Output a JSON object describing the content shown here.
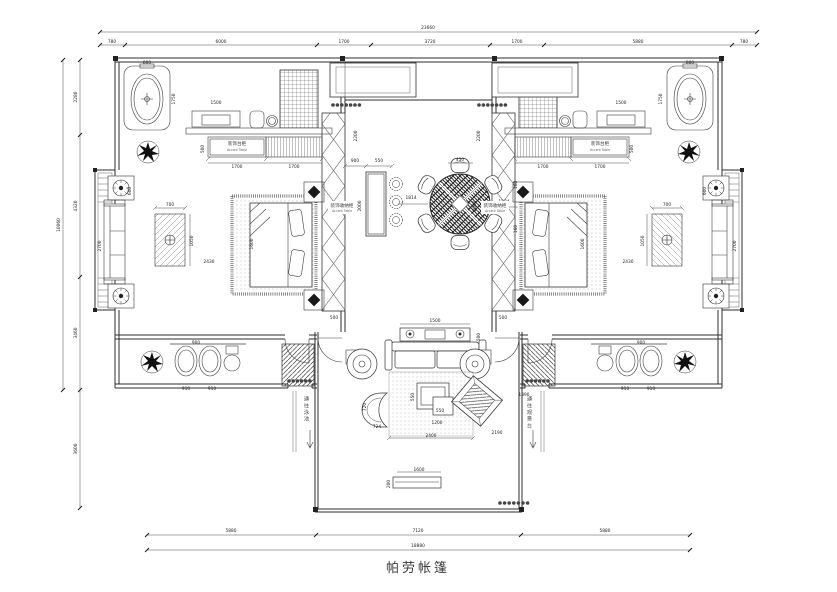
{
  "title": "帕劳帐篷",
  "colors": {
    "line": "#2e2e2e",
    "dark_fill": "#141414",
    "background": "#ffffff"
  },
  "labels": {
    "accent_left_zh": "装饰台柜",
    "accent_left_en": "Accent Table",
    "accent_right_zh": "装饰台柜",
    "accent_right_en": "Accent Table",
    "console_left_zh": "装饰收纳柜",
    "console_left_en": "Accent Table",
    "console_right_zh": "装饰收纳柜",
    "console_right_en": "Accent Table",
    "passage_left": "通往泳池",
    "passage_right": "通往观景台"
  },
  "dimensions": {
    "top": [
      {
        "t": "23660",
        "x": 428,
        "y": 29
      },
      {
        "t": "780",
        "x": 112,
        "y": 43
      },
      {
        "t": "6000",
        "x": 221,
        "y": 43
      },
      {
        "t": "1700",
        "x": 344,
        "y": 43
      },
      {
        "t": "3720",
        "x": 430,
        "y": 43
      },
      {
        "t": "1700",
        "x": 517,
        "y": 43
      },
      {
        "t": "5880",
        "x": 638,
        "y": 43
      },
      {
        "t": "780",
        "x": 744,
        "y": 43
      }
    ],
    "bottom": [
      {
        "t": "5880",
        "x": 231,
        "y": 532
      },
      {
        "t": "7120",
        "x": 418,
        "y": 532
      },
      {
        "t": "5880",
        "x": 605,
        "y": 532
      },
      {
        "t": "18880",
        "x": 418,
        "y": 547
      }
    ],
    "left": [
      {
        "t": "10060",
        "x": 60,
        "y": 225,
        "r": 1
      },
      {
        "t": "2280",
        "x": 77,
        "y": 97,
        "r": 1
      },
      {
        "t": "4320",
        "x": 77,
        "y": 206,
        "r": 1
      },
      {
        "t": "3460",
        "x": 77,
        "y": 333,
        "r": 1
      },
      {
        "t": "3600",
        "x": 77,
        "y": 449,
        "r": 1
      }
    ],
    "interior": [
      {
        "t": "800",
        "x": 147,
        "y": 64
      },
      {
        "t": "1750",
        "x": 175,
        "y": 99,
        "r": 1
      },
      {
        "t": "1500",
        "x": 216,
        "y": 104
      },
      {
        "t": "500",
        "x": 204,
        "y": 149,
        "r": 1
      },
      {
        "t": "1700",
        "x": 237,
        "y": 168
      },
      {
        "t": "1700",
        "x": 294,
        "y": 168
      },
      {
        "t": "600",
        "x": 131,
        "y": 191,
        "r": 1
      },
      {
        "t": "2700",
        "x": 101,
        "y": 246,
        "r": 1
      },
      {
        "t": "700",
        "x": 170,
        "y": 206
      },
      {
        "t": "1050",
        "x": 193,
        "y": 241,
        "r": 1
      },
      {
        "t": "2430",
        "x": 209,
        "y": 263
      },
      {
        "t": "1600",
        "x": 253,
        "y": 244,
        "r": 1
      },
      {
        "t": "900",
        "x": 196,
        "y": 344
      },
      {
        "t": "910",
        "x": 186,
        "y": 390
      },
      {
        "t": "910",
        "x": 212,
        "y": 390
      },
      {
        "t": "2200",
        "x": 357,
        "y": 136,
        "r": 1
      },
      {
        "t": "2000",
        "x": 361,
        "y": 206,
        "r": 1
      },
      {
        "t": "500",
        "x": 334,
        "y": 319
      },
      {
        "t": "900",
        "x": 355,
        "y": 162
      },
      {
        "t": "550",
        "x": 379,
        "y": 162
      },
      {
        "t": "1814",
        "x": 411,
        "y": 199
      },
      {
        "t": "450",
        "x": 460,
        "y": 161
      },
      {
        "t": "1234",
        "x": 504,
        "y": 203
      },
      {
        "t": "160",
        "x": 517,
        "y": 185,
        "r": 1
      },
      {
        "t": "160",
        "x": 517,
        "y": 229,
        "r": 1
      },
      {
        "t": "800",
        "x": 690,
        "y": 64
      },
      {
        "t": "1750",
        "x": 662,
        "y": 99,
        "r": 1
      },
      {
        "t": "1500",
        "x": 621,
        "y": 104
      },
      {
        "t": "500",
        "x": 633,
        "y": 149,
        "r": 1
      },
      {
        "t": "1700",
        "x": 543,
        "y": 168
      },
      {
        "t": "1700",
        "x": 600,
        "y": 168
      },
      {
        "t": "600",
        "x": 706,
        "y": 191,
        "r": 1
      },
      {
        "t": "2700",
        "x": 736,
        "y": 246,
        "r": 1
      },
      {
        "t": "700",
        "x": 667,
        "y": 206
      },
      {
        "t": "1050",
        "x": 644,
        "y": 241,
        "r": 1
      },
      {
        "t": "2430",
        "x": 628,
        "y": 263
      },
      {
        "t": "1600",
        "x": 584,
        "y": 244,
        "r": 1
      },
      {
        "t": "900",
        "x": 641,
        "y": 344
      },
      {
        "t": "910",
        "x": 625,
        "y": 390
      },
      {
        "t": "910",
        "x": 651,
        "y": 390
      },
      {
        "t": "2200",
        "x": 480,
        "y": 136,
        "r": 1
      },
      {
        "t": "2000",
        "x": 476,
        "y": 206,
        "r": 1
      },
      {
        "t": "500",
        "x": 503,
        "y": 319
      },
      {
        "t": "1500",
        "x": 435,
        "y": 322
      },
      {
        "t": "500",
        "x": 480,
        "y": 337,
        "r": 1
      },
      {
        "t": "550",
        "x": 440,
        "y": 412
      },
      {
        "t": "1200",
        "x": 437,
        "y": 424
      },
      {
        "t": "550",
        "x": 414,
        "y": 397,
        "r": 1
      },
      {
        "t": "720",
        "x": 366,
        "y": 407,
        "r": 1
      },
      {
        "t": "724",
        "x": 377,
        "y": 428
      },
      {
        "t": "2400",
        "x": 431,
        "y": 437
      },
      {
        "t": "2190",
        "x": 497,
        "y": 434
      },
      {
        "t": "1390",
        "x": 524,
        "y": 396
      },
      {
        "t": "1600",
        "x": 419,
        "y": 471
      },
      {
        "t": "200",
        "x": 390,
        "y": 484,
        "r": 1
      }
    ]
  }
}
